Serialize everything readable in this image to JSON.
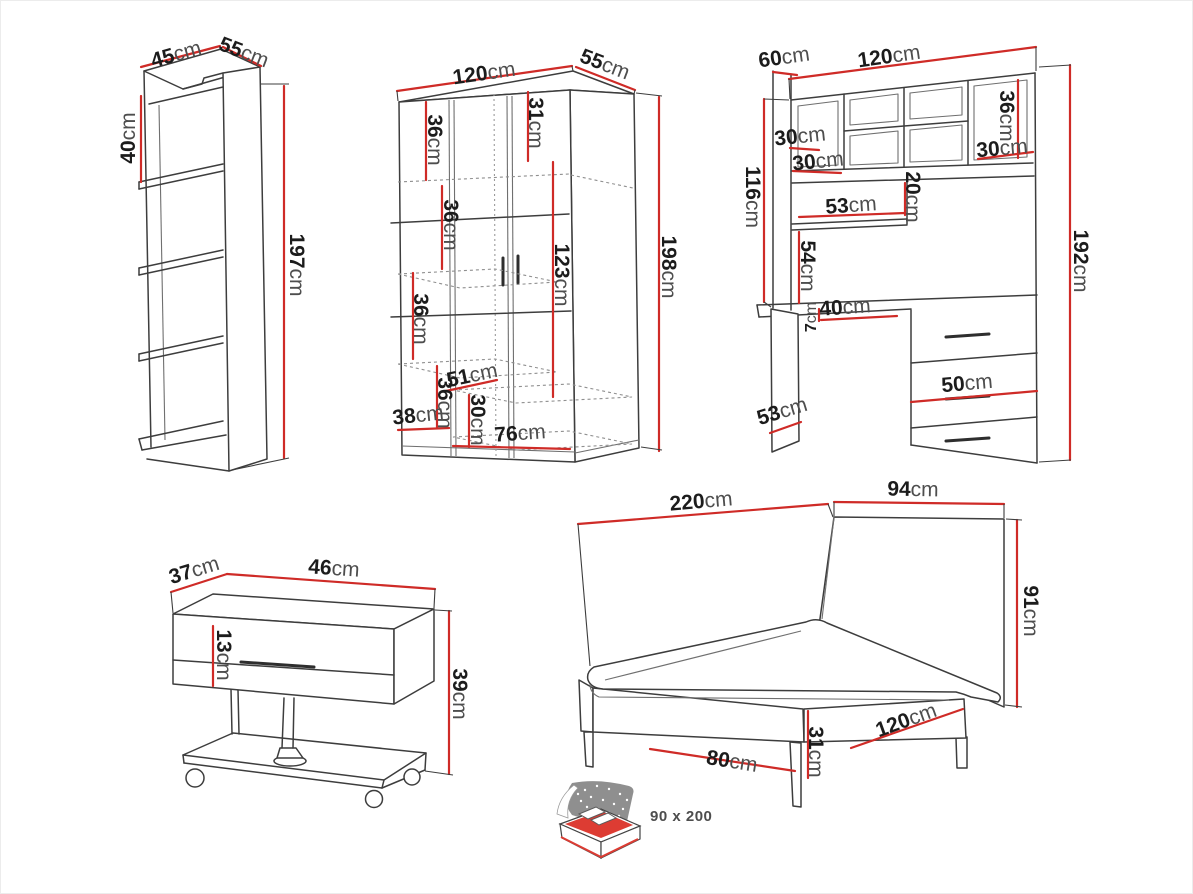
{
  "unit": "cm",
  "colors": {
    "dimension_line": "#cf2b27",
    "drawing_line": "#3d3d3d",
    "mattress_accent": "#dd3c33"
  },
  "pieces": {
    "shelf_unit": {
      "width": "45",
      "depth": "55",
      "cell_height": "40",
      "height": "197"
    },
    "wardrobe": {
      "width": "120",
      "depth": "55",
      "height": "198",
      "shelf_1": "36",
      "top_section": "31",
      "shelf_2": "36",
      "shelf_3": "36",
      "hanging_height": "123",
      "inner_width": "51",
      "bottom_shelf": "36",
      "drawer_height": "30",
      "plinth_width": "38",
      "bottom_depth": "76"
    },
    "desk": {
      "depth": "60",
      "width": "120",
      "height": "192",
      "cubby_depth": "30",
      "cubby_width": "30",
      "cubby_height": "36",
      "right_cubby_width": "30",
      "hutch_height": "116",
      "shelf_width": "53",
      "shelf_height": "20",
      "open_height": "54",
      "top_thickness": "7",
      "knee_space": "40",
      "drawer_width": "50",
      "side_depth": "53"
    },
    "nightstand": {
      "depth": "37",
      "width": "46",
      "drawer_height": "13",
      "height": "39"
    },
    "bed": {
      "length": "220",
      "headboard_width": "94",
      "headboard_height": "91",
      "base_height": "31",
      "footboard_width": "120",
      "side_width": "80",
      "mattress_size": "90 x 200"
    }
  }
}
